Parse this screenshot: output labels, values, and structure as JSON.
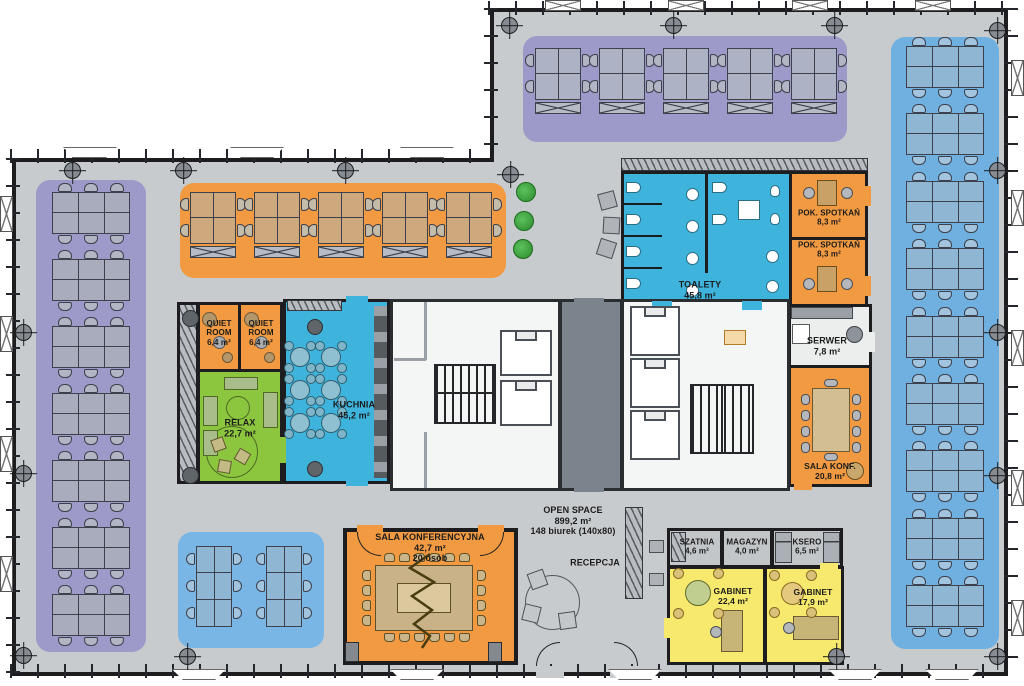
{
  "plan": {
    "title": "Office floor plan",
    "open_space": {
      "name": "OPEN SPACE",
      "area": "899,2 m²",
      "desks": "148 biurek (140x80)"
    },
    "recepcja": {
      "name": "RECEPCJA"
    },
    "rooms": {
      "quiet_room_1": {
        "name": "QUIET ROOM",
        "area": "6,4 m²"
      },
      "quiet_room_2": {
        "name": "QUIET ROOM",
        "area": "6,4 m²"
      },
      "relax": {
        "name": "RELAX",
        "area": "22,7 m²"
      },
      "kuchnia": {
        "name": "KUCHNIA",
        "area": "45,2 m²"
      },
      "toalety": {
        "name": "TOALETY",
        "area": "45,8 m²"
      },
      "pok_spotkan_1": {
        "name": "POK. SPOTKAŃ",
        "area": "8,3 m²"
      },
      "pok_spotkan_2": {
        "name": "POK. SPOTKAŃ",
        "area": "8,3 m²"
      },
      "serwer": {
        "name": "SERWER",
        "area": "7,8 m²"
      },
      "sala_konf": {
        "name": "SALA KONF.",
        "area": "20,8 m²"
      },
      "sala_konferencyjna": {
        "name": "SALA KONFERENCYJNA",
        "area": "42,7 m²",
        "capacity": "20 osób"
      },
      "szatnia": {
        "name": "SZATNIA",
        "area": "4,6 m²"
      },
      "magazyn": {
        "name": "MAGAZYN",
        "area": "4,0 m²"
      },
      "ksero": {
        "name": "KSERO",
        "area": "6,5 m²"
      },
      "gabinet_1": {
        "name": "GABINET",
        "area": "22,4 m²"
      },
      "gabinet_2": {
        "name": "GABINET",
        "area": "17,9 m²"
      }
    },
    "desk_zones": {
      "left": {
        "clusters": 7,
        "desks_per_cluster": 6,
        "total": 42
      },
      "right": {
        "clusters": 9,
        "desks_per_cluster": 6,
        "total": 54
      },
      "top_orange": {
        "clusters": 5,
        "desks_per_cluster": 4,
        "total": 20
      },
      "wing_purple": {
        "clusters": 5,
        "desks_per_cluster": 4,
        "total": 20
      },
      "bottom_blue": {
        "clusters": 2,
        "desks_per_cluster": 6,
        "total": 12
      },
      "total_desks": 148
    },
    "colors": {
      "floor": "#c7cbce",
      "wall": "#1d1d1f",
      "zone_purple": "#9d9aca",
      "zone_orange": "#f19a42",
      "zone_blue": "#6fb0e1",
      "zone_blue_light": "#79b6e6",
      "room_cyan": "#3eb4dd",
      "room_green": "#8cc63f",
      "room_yellow": "#f6e96d",
      "room_gray": "#c2c6c9",
      "core_white": "#f4f5f5",
      "core_dark": "#7b848c",
      "desk_gray": "#a8acbd",
      "desk_tan": "#cda97d",
      "desk_blue": "#8fb6d2",
      "desk_purple": "#adb2c4",
      "table_tan": "#d3bd92",
      "plant_green": "#3da23d"
    }
  }
}
